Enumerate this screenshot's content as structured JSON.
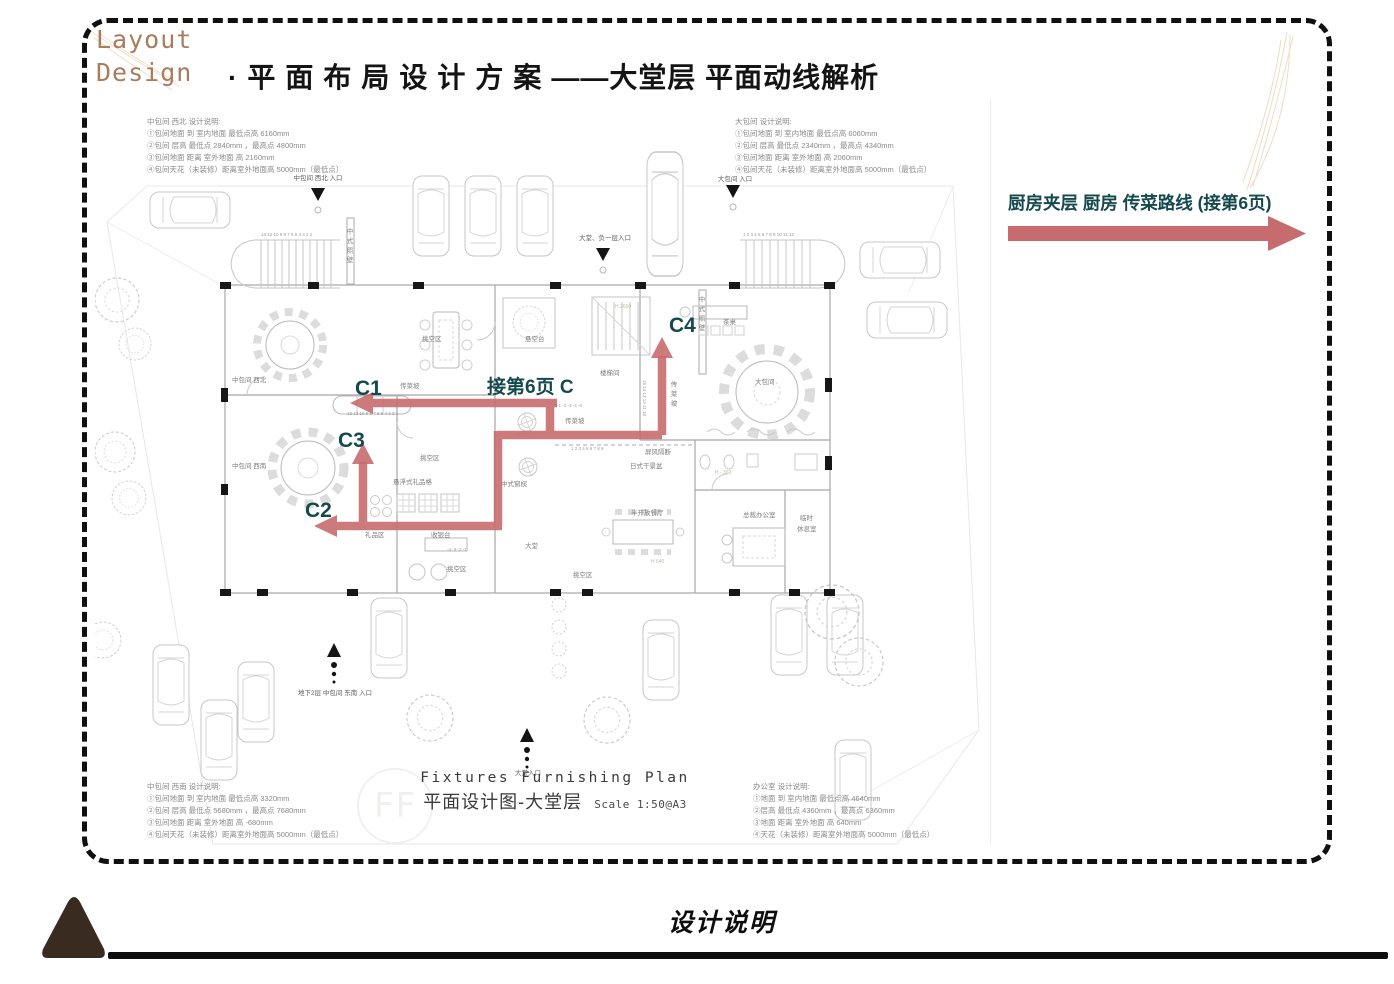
{
  "header": {
    "brand_line1": "Layout",
    "brand_line2": "Design",
    "title_part1": "·平面布局设计方案",
    "title_part2": "——大堂层 平面动线解析"
  },
  "side_note": {
    "text": "厨房夹层 厨房 传菜路线 (接第6页)"
  },
  "footer": {
    "title": "设计说明"
  },
  "plan": {
    "notes_tl": {
      "lines": [
        "中包间 西北 设计说明:",
        "①包间地面 到 室内地面 最低点高 6160mm",
        "②包间 层高 最低点 2840mm ，最高点 4800mm",
        "③包间地面 距离 室外地面 高 2160mm",
        "④包间天花（未装修）距离室外地面高 5000mm（最低点）"
      ]
    },
    "notes_tr": {
      "lines": [
        "大包间 设计说明:",
        "①包间地面 到 室内地面 最低点高 6060mm",
        "②包间 层高 最低点 2340mm ，最高点 4340mm",
        "③包间地面 距离 室外地面 高 2060mm",
        "④包间天花（未装修）距离室外地面高 5000mm（最低点）"
      ]
    },
    "notes_bl": {
      "lines": [
        "中包间 西南 设计说明:",
        "①包间地面 到 室内地面 最低点高 3320mm",
        "②包间 层高 最低点 5680mm ，最高点 7680mm",
        "③包间地面 距离 室外地面 高 -680mm",
        "④包间天花（未装修）距离室外地面高 5000mm（最低点）"
      ]
    },
    "notes_br": {
      "lines": [
        "办公室 设计说明:",
        "①地面 到 室内地面 最低点高 4640mm",
        "②层高 最低点 4360mm ，最高点 6360mm",
        "③地面 距离 室外地面 高 640mm",
        "④天花（未装修）距离室外地面高 5000mm（最低点）"
      ]
    },
    "title_en": "Fixtures Furnishing Plan",
    "title_zh": "平面设计图-大堂层",
    "title_scale": "Scale 1:50@A3",
    "watermark": "FF",
    "routes": {
      "c1": "C1",
      "c2": "C2",
      "c3": "C3",
      "c4": "C4",
      "continue_label": "接第6页 C"
    },
    "entrances": {
      "nw": "中包间 西北 入口",
      "lobby_b1": "大堂、负一层入口",
      "large_room": "大包间 入口",
      "se_b2": "地下2层 中包间 东南 入口",
      "lobby_main": "大堂入口"
    },
    "rooms": {
      "nw_room": "中包间 西北",
      "sw_room": "中包间 西南",
      "screen_wall_1": "中式照壁",
      "screen_wall_2": "中式照壁",
      "stair_room": "楼梯间",
      "food_ramp_v": "传菜坡",
      "food_ramp_h1": "传菜坡",
      "food_ramp_h2": "传菜坡",
      "void_1": "挑空区",
      "void_2": "挑空区",
      "void_3": "挑空区",
      "void_4": "挑空区",
      "float_stage": "悬空台",
      "gift_shelf": "悬浮式礼品格",
      "gift_zone": "礼品区",
      "cashier": "收银台",
      "lobby": "大堂",
      "window_lattice": "中式窗棂",
      "screen_partition": "屏风隔断",
      "dry_garden": "日式干景盆",
      "open_dining": "半开放餐厅",
      "ceo_office": "总裁办公室",
      "rest_room_l1": "临时",
      "rest_room_l2": "休息室",
      "large_room": "大包间",
      "tea_table": "茶桌"
    },
    "marks": {
      "stair_nums_tl": "13 12   10 9 8 7 6 5 4 3 2 1",
      "stair_nums_tr": "1 2 3 4 5 6 7 8 9 10  11  12",
      "stair_nums_c1": "13 12  10 9 8 7 6 5 4 3 2 1",
      "stair_nums_mid": "-1 -2 -3 -4 -5",
      "stair_nums_b": "1 2 3 4 5 6 7 8 9",
      "neg_nums": "-4 -3 -2 -1",
      "stair_nums_v": "15 14 13 12 11 10",
      "h2660": "H 2660",
      "level_zero": "± 0.00",
      "h360": "H - 360",
      "h640": "H 640"
    }
  },
  "colors": {
    "accent_red": "#C66B6E",
    "label_teal": "#15494E",
    "brand_brown": "#A87C5F",
    "ink": "#111111",
    "plan_gray": "#9a9a9a"
  }
}
